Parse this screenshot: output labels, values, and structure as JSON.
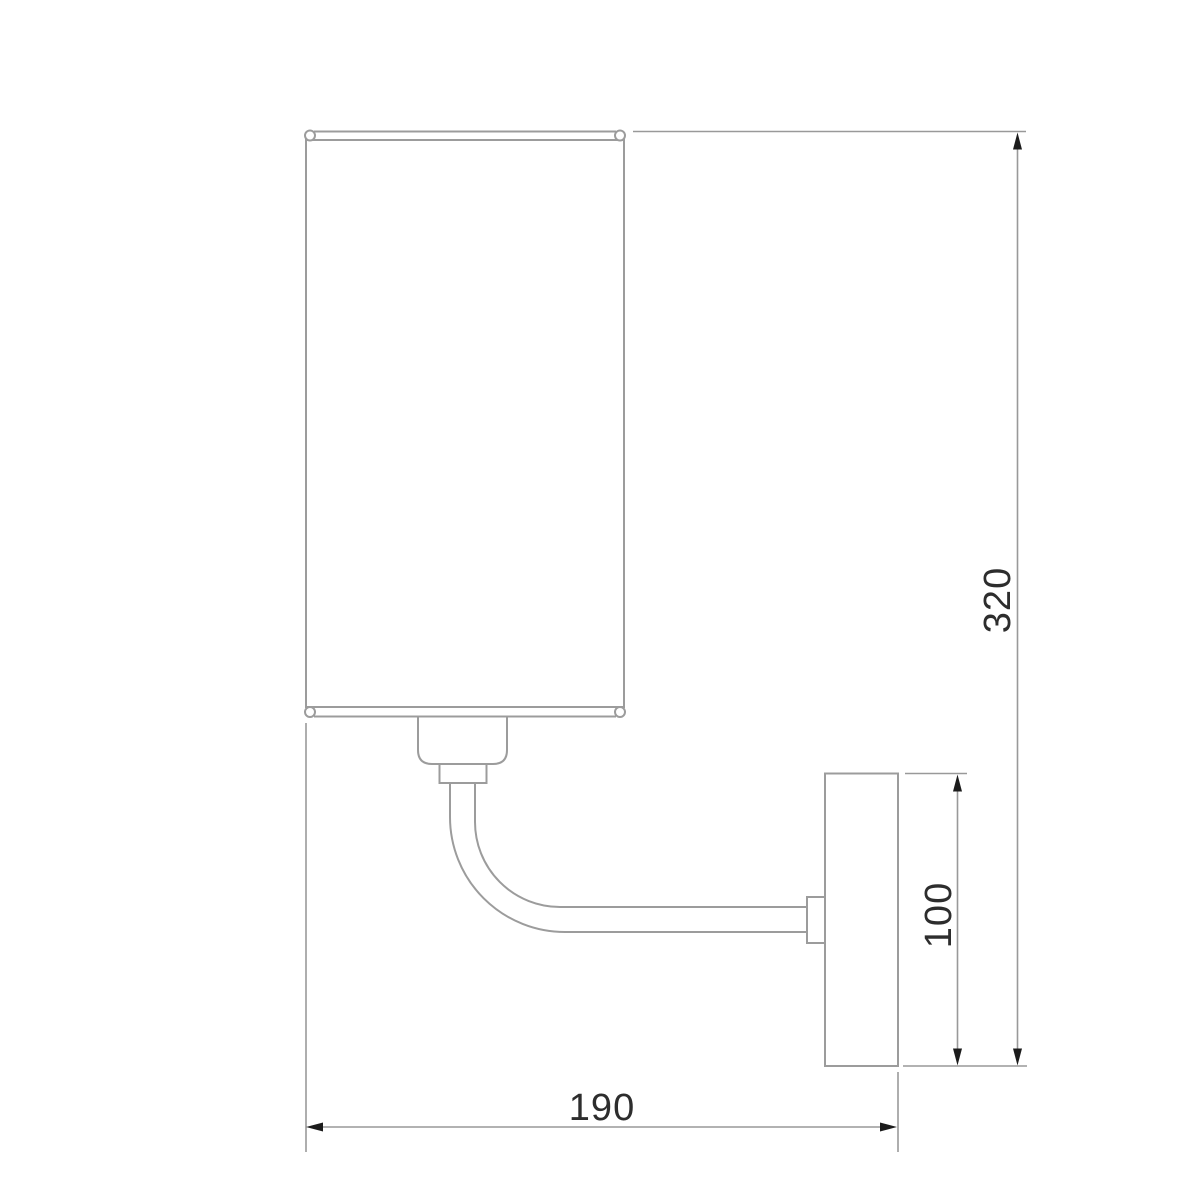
{
  "page": {
    "background": "#ffffff"
  },
  "dimensions": {
    "overall_height": "320",
    "backplate_height": "100",
    "projection": "190"
  },
  "colors": {
    "outline": "#9c9c9c",
    "dimension_line": "#999999",
    "arrow": "#1c1c1c",
    "label_text": "#2d2d2d",
    "bead_fill": "#ffffff"
  }
}
